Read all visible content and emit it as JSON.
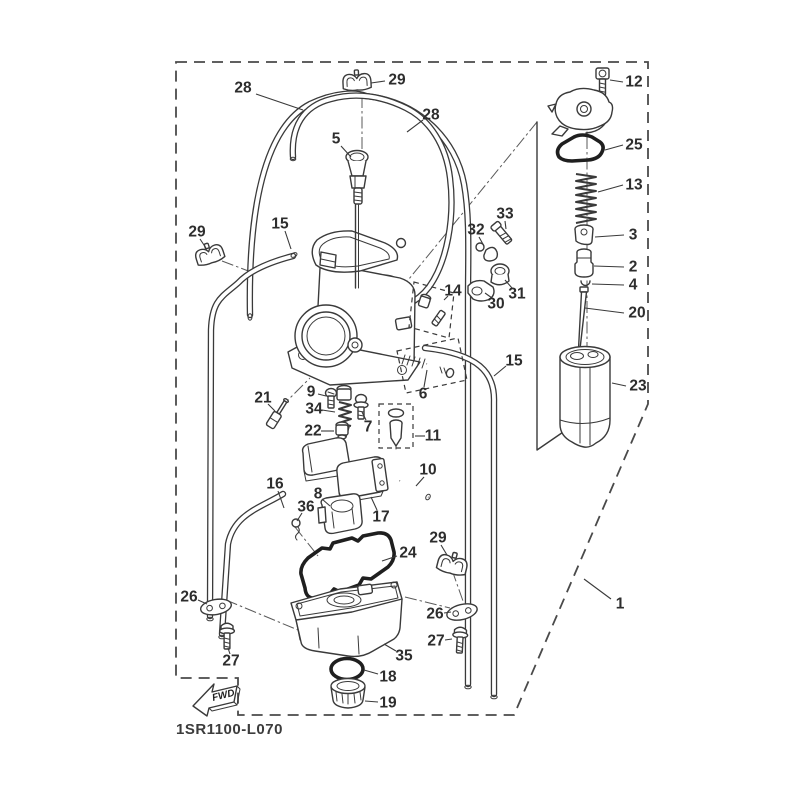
{
  "diagram": {
    "code": "1SR1100-L070",
    "fwd_label": "FWD",
    "background": "#ffffff",
    "line_color": "#3a3a3a",
    "bold_line_color": "#1f1f1f",
    "label_color": "#2d2d2d"
  },
  "callouts": [
    {
      "n": "28",
      "lx": 243,
      "ly": 88,
      "ax": 256,
      "ay": 94,
      "bx": 303,
      "by": 110
    },
    {
      "n": "29",
      "lx": 397,
      "ly": 80,
      "ax": 385,
      "ay": 81,
      "bx": 371,
      "by": 83
    },
    {
      "n": "28",
      "lx": 431,
      "ly": 115,
      "ax": 423,
      "ay": 120,
      "bx": 407,
      "by": 132
    },
    {
      "n": "5",
      "lx": 336,
      "ly": 139,
      "ax": 341,
      "ay": 146,
      "bx": 351,
      "by": 157
    },
    {
      "n": "15",
      "lx": 280,
      "ly": 224,
      "ax": 285,
      "ay": 231,
      "bx": 291,
      "by": 249
    },
    {
      "n": "29",
      "lx": 197,
      "ly": 232,
      "ax": 200,
      "ay": 239,
      "bx": 206,
      "by": 248
    },
    {
      "n": "12",
      "lx": 634,
      "ly": 82,
      "ax": 623,
      "ay": 82,
      "bx": 610,
      "by": 80
    },
    {
      "n": "25",
      "lx": 634,
      "ly": 145,
      "ax": 623,
      "ay": 145,
      "bx": 605,
      "by": 150
    },
    {
      "n": "13",
      "lx": 634,
      "ly": 185,
      "ax": 623,
      "ay": 185,
      "bx": 598,
      "by": 192
    },
    {
      "n": "3",
      "lx": 633,
      "ly": 235,
      "ax": 624,
      "ay": 235,
      "bx": 595,
      "by": 237
    },
    {
      "n": "2",
      "lx": 633,
      "ly": 267,
      "ax": 624,
      "ay": 267,
      "bx": 594,
      "by": 266
    },
    {
      "n": "4",
      "lx": 633,
      "ly": 285,
      "ax": 624,
      "ay": 285,
      "bx": 592,
      "by": 284
    },
    {
      "n": "20",
      "lx": 637,
      "ly": 313,
      "ax": 624,
      "ay": 313,
      "bx": 585,
      "by": 308
    },
    {
      "n": "23",
      "lx": 638,
      "ly": 386,
      "ax": 626,
      "ay": 386,
      "bx": 612,
      "by": 383
    },
    {
      "n": "33",
      "lx": 505,
      "ly": 214,
      "ax": 505,
      "ay": 221,
      "bx": 506,
      "by": 229
    },
    {
      "n": "32",
      "lx": 476,
      "ly": 230,
      "ax": 479,
      "ay": 237,
      "bx": 484,
      "by": 246
    },
    {
      "n": "31",
      "lx": 517,
      "ly": 294,
      "ax": 512,
      "ay": 288,
      "bx": 505,
      "by": 280
    },
    {
      "n": "30",
      "lx": 496,
      "ly": 304,
      "ax": 492,
      "ay": 298,
      "bx": 485,
      "by": 293
    },
    {
      "n": "14",
      "lx": 453,
      "ly": 291,
      "ax": 448,
      "ay": 296,
      "bx": 444,
      "by": 300
    },
    {
      "n": "15",
      "lx": 514,
      "ly": 361,
      "ax": 506,
      "ay": 366,
      "bx": 494,
      "by": 376
    },
    {
      "n": "9",
      "lx": 311,
      "ly": 392,
      "ax": 318,
      "ay": 394,
      "bx": 326,
      "by": 396
    },
    {
      "n": "34",
      "lx": 314,
      "ly": 409,
      "ax": 322,
      "ay": 410,
      "bx": 335,
      "by": 412
    },
    {
      "n": "21",
      "lx": 263,
      "ly": 398,
      "ax": 268,
      "ay": 404,
      "bx": 275,
      "by": 411
    },
    {
      "n": "22",
      "lx": 313,
      "ly": 431,
      "ax": 321,
      "ay": 431,
      "bx": 334,
      "by": 431
    },
    {
      "n": "7",
      "lx": 368,
      "ly": 427,
      "ax": 366,
      "ay": 420,
      "bx": 362,
      "by": 412
    },
    {
      "n": "11",
      "lx": 433,
      "ly": 436,
      "ax": 425,
      "ay": 436,
      "bx": 415,
      "by": 436
    },
    {
      "n": "6",
      "lx": 423,
      "ly": 394,
      "ax": 424,
      "ay": 387,
      "bx": 427,
      "by": 370
    },
    {
      "n": "16",
      "lx": 275,
      "ly": 484,
      "ax": 278,
      "ay": 491,
      "bx": 284,
      "by": 508
    },
    {
      "n": "36",
      "lx": 306,
      "ly": 507,
      "ax": 302,
      "ay": 513,
      "bx": 297,
      "by": 521
    },
    {
      "n": "8",
      "lx": 318,
      "ly": 494,
      "ax": 322,
      "ay": 499,
      "bx": 330,
      "by": 506
    },
    {
      "n": "17",
      "lx": 381,
      "ly": 517,
      "ax": 377,
      "ay": 510,
      "bx": 371,
      "by": 497
    },
    {
      "n": "10",
      "lx": 428,
      "ly": 470,
      "ax": 424,
      "ay": 477,
      "bx": 416,
      "by": 486
    },
    {
      "n": "29",
      "lx": 438,
      "ly": 538,
      "ax": 441,
      "ay": 545,
      "bx": 447,
      "by": 555
    },
    {
      "n": "24",
      "lx": 408,
      "ly": 553,
      "ax": 397,
      "ay": 556,
      "bx": 382,
      "by": 561
    },
    {
      "n": "26",
      "lx": 189,
      "ly": 597,
      "ax": 198,
      "ay": 600,
      "bx": 207,
      "by": 604
    },
    {
      "n": "27",
      "lx": 231,
      "ly": 661,
      "ax": 230,
      "ay": 654,
      "bx": 228,
      "by": 648
    },
    {
      "n": "26",
      "lx": 435,
      "ly": 614,
      "ax": 444,
      "ay": 613,
      "bx": 451,
      "by": 612
    },
    {
      "n": "27",
      "lx": 436,
      "ly": 641,
      "ax": 445,
      "ay": 640,
      "bx": 452,
      "by": 639
    },
    {
      "n": "35",
      "lx": 404,
      "ly": 656,
      "ax": 396,
      "ay": 651,
      "bx": 384,
      "by": 644
    },
    {
      "n": "18",
      "lx": 388,
      "ly": 677,
      "ax": 378,
      "ay": 674,
      "bx": 364,
      "by": 670
    },
    {
      "n": "19",
      "lx": 388,
      "ly": 703,
      "ax": 378,
      "ay": 702,
      "bx": 365,
      "by": 701
    },
    {
      "n": "1",
      "lx": 620,
      "ly": 604,
      "ax": 611,
      "ay": 599,
      "bx": 584,
      "by": 579
    }
  ]
}
